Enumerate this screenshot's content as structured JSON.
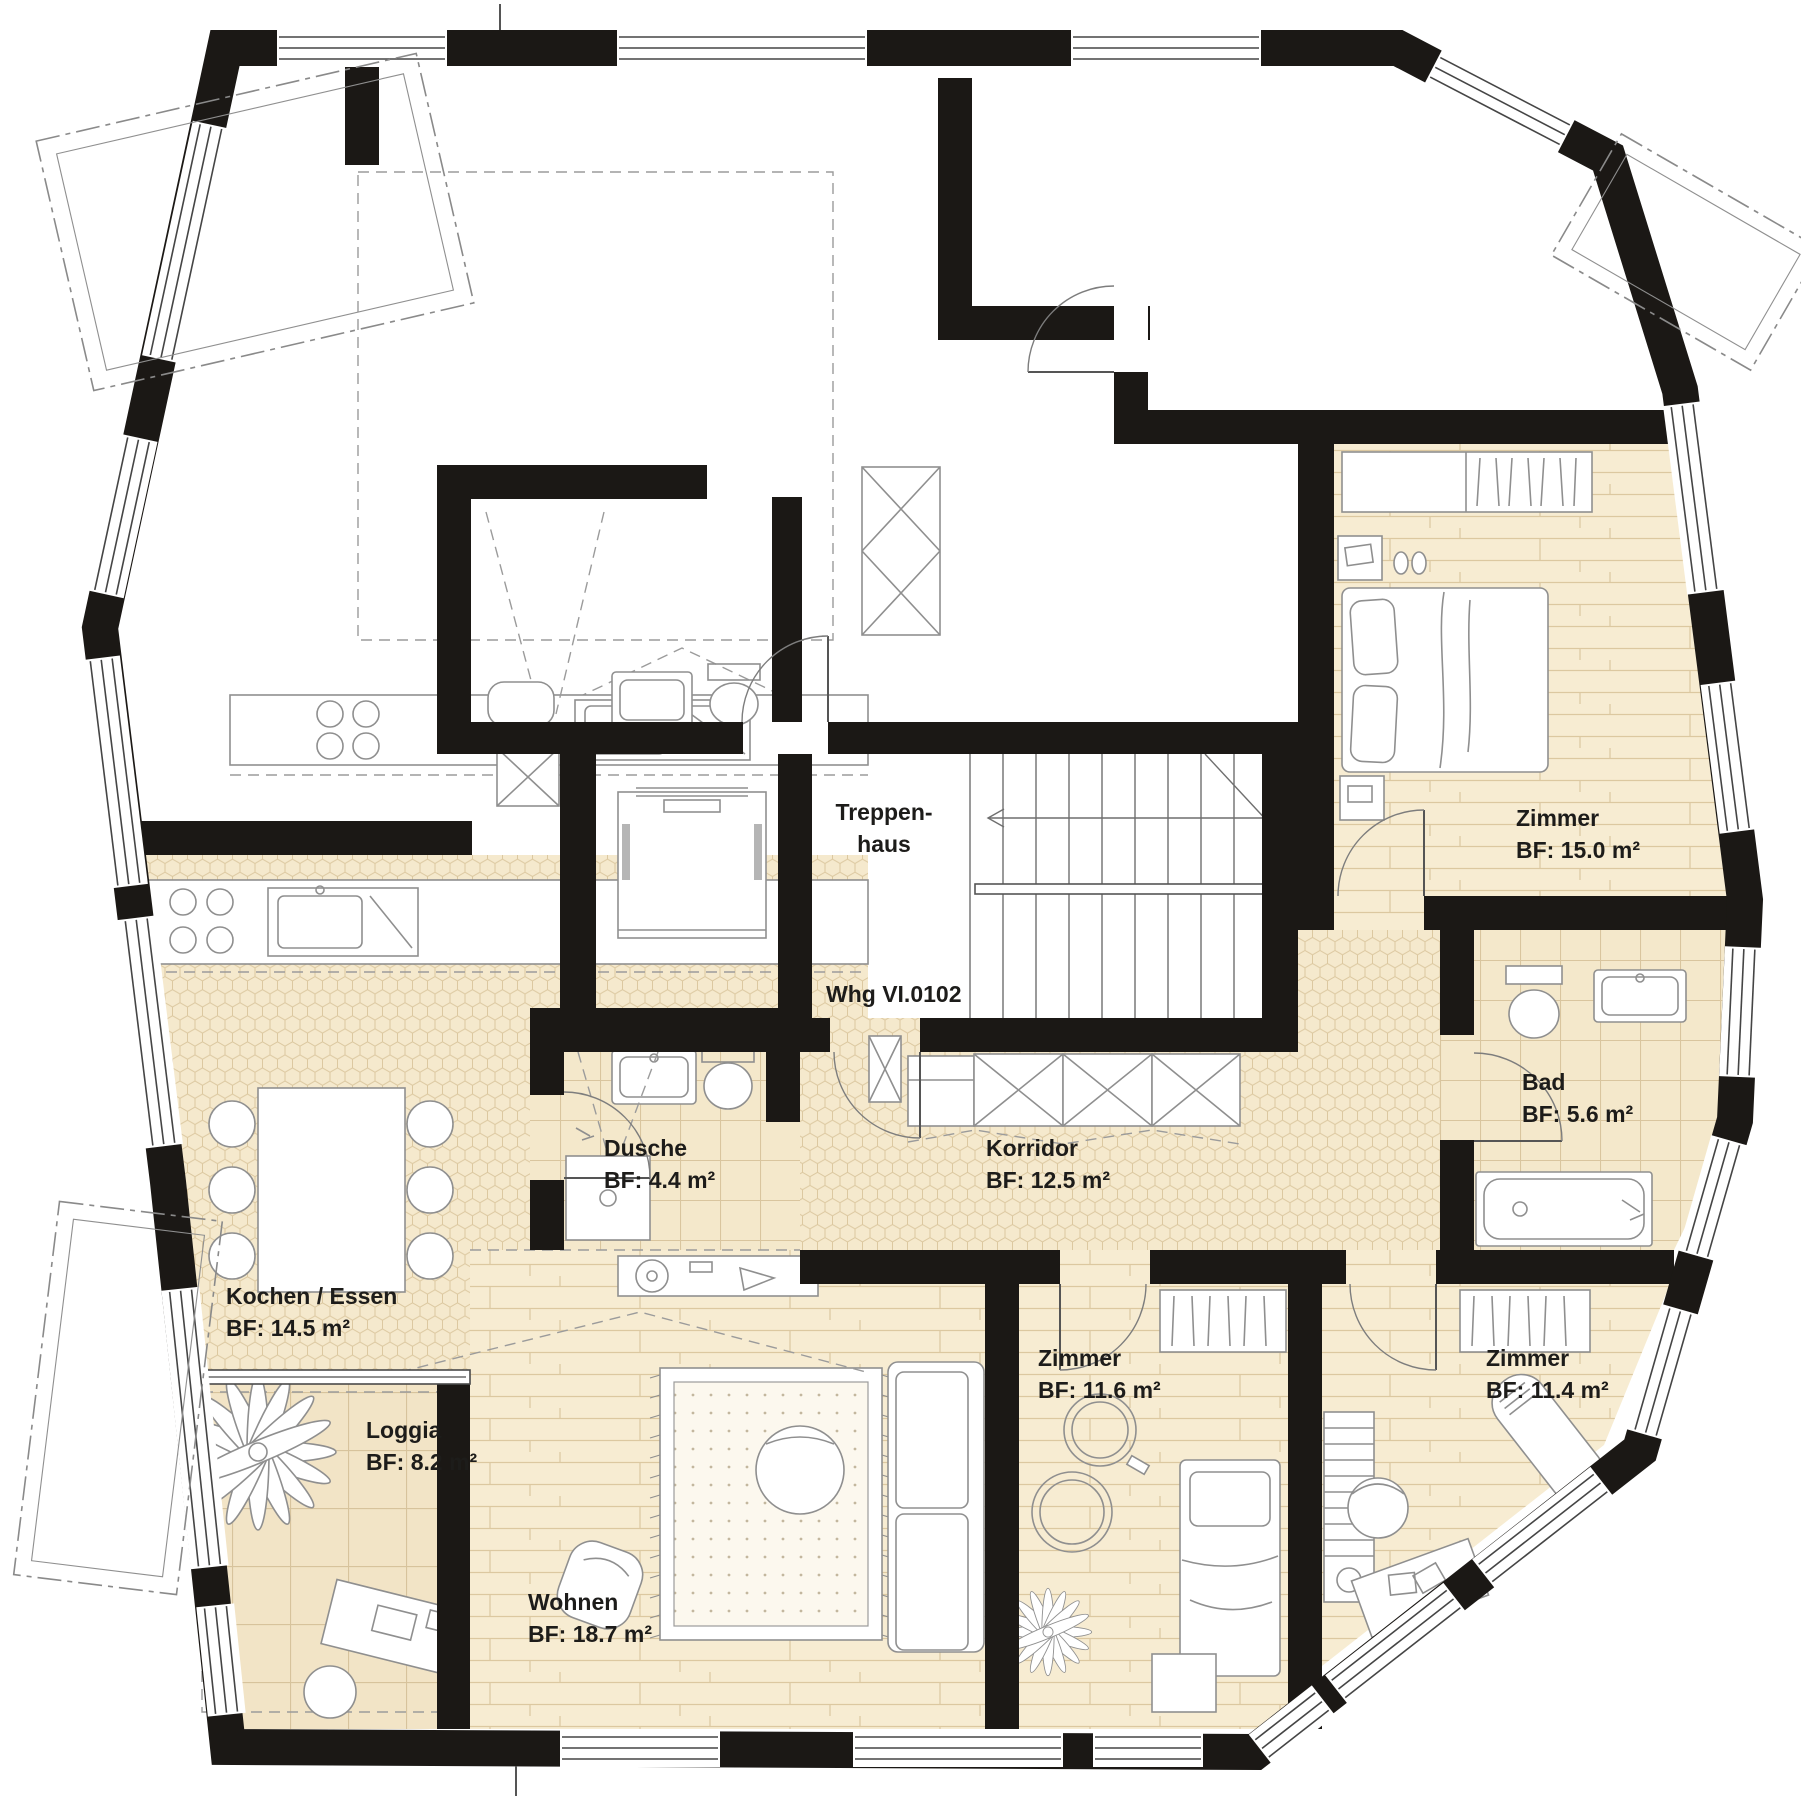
{
  "plan": {
    "title": "Whg VI.0102",
    "stairwell": {
      "line1": "Treppen-",
      "line2": "haus"
    },
    "rooms": [
      {
        "id": "zimmer15",
        "name": "Zimmer",
        "area": "BF: 15.0 m²"
      },
      {
        "id": "bad",
        "name": "Bad",
        "area": "BF: 5.6 m²"
      },
      {
        "id": "dusche",
        "name": "Dusche",
        "area": "BF: 4.4 m²"
      },
      {
        "id": "korridor",
        "name": "Korridor",
        "area": "BF: 12.5 m²"
      },
      {
        "id": "kochen",
        "name": "Kochen / Essen",
        "area": "BF: 14.5 m²"
      },
      {
        "id": "loggia",
        "name": "Loggia",
        "area": "BF: 8.2 m²"
      },
      {
        "id": "wohnen",
        "name": "Wohnen",
        "area": "BF: 18.7 m²"
      },
      {
        "id": "zimmer116",
        "name": "Zimmer",
        "area": "BF: 11.6 m²"
      },
      {
        "id": "zimmer114",
        "name": "Zimmer",
        "area": "BF: 11.4 m²"
      }
    ],
    "colors": {
      "wall": "#1b1815",
      "line": "#8f8f8f",
      "floor_wood": "#f7ecd2",
      "floor_hex": "#f5e9cd",
      "floor_tile_small": "#f4e8cb",
      "floor_tile_large": "#f2e4c6"
    }
  }
}
